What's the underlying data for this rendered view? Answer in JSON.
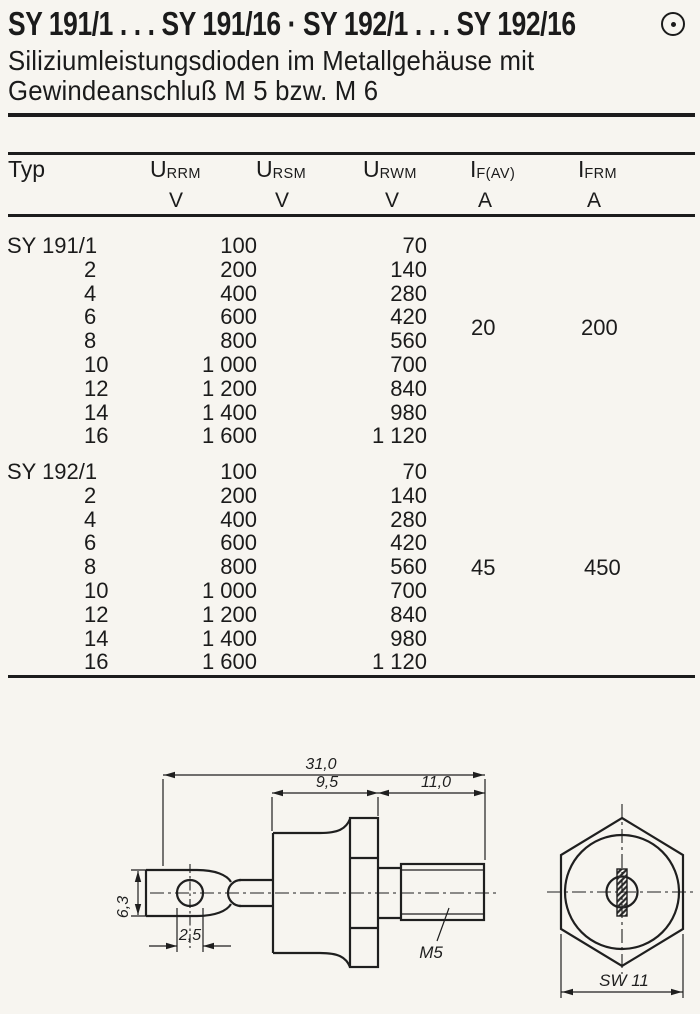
{
  "header": {
    "title": "SY 191/1 . . . SY 191/16 · SY 192/1 . . . SY 192/16",
    "brand_mark_icon": "circle-dot",
    "subtitle_line1": "Siliziumleistungsdioden im Metallgehäuse mit",
    "subtitle_line2": "Gewindeanschluß M 5 bzw. M 6"
  },
  "table": {
    "columns": [
      {
        "label": "Typ",
        "sub": "",
        "unit": ""
      },
      {
        "label": "U",
        "sub": "RRM",
        "unit": "V"
      },
      {
        "label": "U",
        "sub": "RSM",
        "unit": "V"
      },
      {
        "label": "U",
        "sub": "RWM",
        "unit": "V"
      },
      {
        "label": "I",
        "sub": "F(AV)",
        "unit": "A"
      },
      {
        "label": "I",
        "sub": "FRM",
        "unit": "A"
      }
    ],
    "groups": [
      {
        "name": "SY 191",
        "rows": [
          {
            "type": "SY 191/1",
            "urrm": "100",
            "urwm": "70"
          },
          {
            "type": "2",
            "urrm": "200",
            "urwm": "140"
          },
          {
            "type": "4",
            "urrm": "400",
            "urwm": "280"
          },
          {
            "type": "6",
            "urrm": "600",
            "urwm": "420"
          },
          {
            "type": "8",
            "urrm": "800",
            "urwm": "560"
          },
          {
            "type": "10",
            "urrm": "1 000",
            "urwm": "700"
          },
          {
            "type": "12",
            "urrm": "1 200",
            "urwm": "840"
          },
          {
            "type": "14",
            "urrm": "1 400",
            "urwm": "980"
          },
          {
            "type": "16",
            "urrm": "1 600",
            "urwm": "1 120"
          }
        ],
        "if_av": "20",
        "ifrm": "200"
      },
      {
        "name": "SY 192",
        "rows": [
          {
            "type": "SY 192/1",
            "urrm": "100",
            "urwm": "70"
          },
          {
            "type": "2",
            "urrm": "200",
            "urwm": "140"
          },
          {
            "type": "4",
            "urrm": "400",
            "urwm": "280"
          },
          {
            "type": "6",
            "urrm": "600",
            "urwm": "420"
          },
          {
            "type": "8",
            "urrm": "800",
            "urwm": "560"
          },
          {
            "type": "10",
            "urrm": "1 000",
            "urwm": "700"
          },
          {
            "type": "12",
            "urrm": "1 200",
            "urwm": "840"
          },
          {
            "type": "14",
            "urrm": "1 400",
            "urwm": "980"
          },
          {
            "type": "16",
            "urrm": "1 600",
            "urwm": "1 120"
          }
        ],
        "if_av": "45",
        "ifrm": "450"
      }
    ]
  },
  "drawing": {
    "dim_overall": "31,0",
    "dim_body": "9,5",
    "dim_stud": "11,0",
    "dim_tab_height": "6,3",
    "dim_hole": "2,5",
    "thread_label": "M5",
    "wrench_size": "SW 11"
  }
}
